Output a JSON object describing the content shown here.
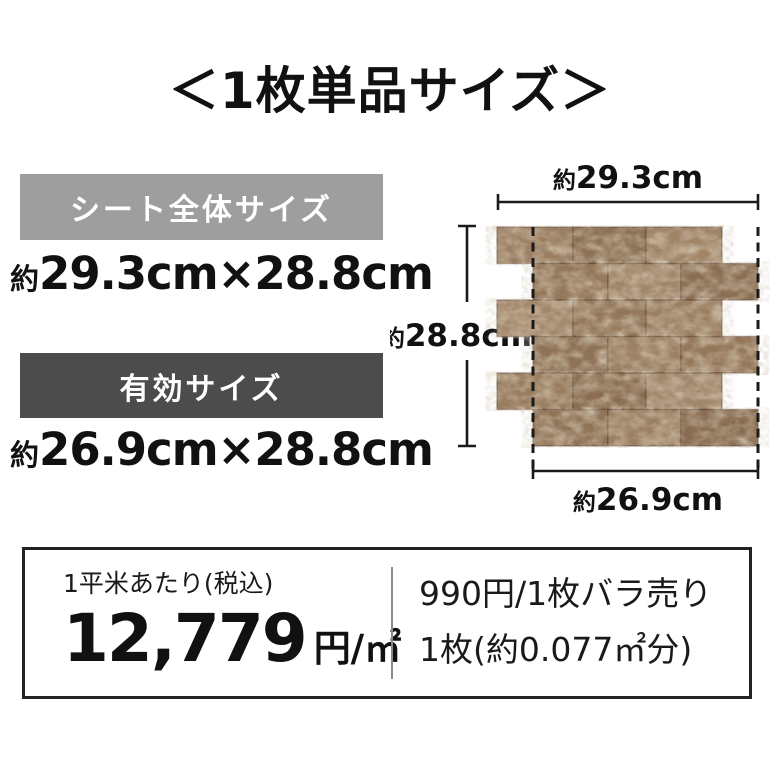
{
  "title": "＜1枚単品サイズ＞",
  "colors": {
    "background": "#ffffff",
    "sheet_banner_bg": "#9e9e9e",
    "effective_banner_bg": "#4c4c4c",
    "banner_text": "#ffffff",
    "text": "#111111",
    "dimension_line": "#1a1a1a",
    "price_box_border": "#222222",
    "price_box_divider": "#8a8a8a",
    "tile_joint": "rgba(84,64,46,0.5)"
  },
  "size_sections": [
    {
      "banner": "シート全体サイズ",
      "approx": "約",
      "value": "29.3cm×28.8cm"
    },
    {
      "banner": "有効サイズ",
      "approx": "約",
      "value": "26.9cm×28.8cm"
    }
  ],
  "diagram": {
    "width_label": {
      "approx": "約",
      "value": "29.3cm"
    },
    "height_label": {
      "approx": "約",
      "value": "28.8cm"
    },
    "effective_width_label": {
      "approx": "約",
      "value": "26.9cm"
    },
    "tiles": {
      "rows": 6,
      "row_height": 36.5,
      "row_width": 225,
      "sheet_width": 261,
      "sheet_height": 219,
      "odd_row_joints": [
        0,
        76,
        149,
        225
      ],
      "even_row_joints": [
        36,
        111,
        184,
        261
      ],
      "colors": [
        [
          "#9a7d60",
          "#8d7154",
          "#a08466"
        ],
        [
          "#95785a",
          "#a2876a",
          "#8b6e52"
        ],
        [
          "#a3886b",
          "#937659",
          "#9c8062"
        ],
        [
          "#8e7255",
          "#9d8163",
          "#957759"
        ],
        [
          "#997c5e",
          "#8a6d50",
          "#a1866a"
        ],
        [
          "#907356",
          "#9b7f61",
          "#886b4f"
        ]
      ]
    }
  },
  "price_box": {
    "per_sqm": {
      "caption": "1平米あたり(税込)",
      "amount": "12,779",
      "unit": "円/㎡"
    },
    "per_piece": {
      "line1": "990円/1枚バラ売り",
      "line2": "1枚(約0.077㎡分)"
    }
  }
}
